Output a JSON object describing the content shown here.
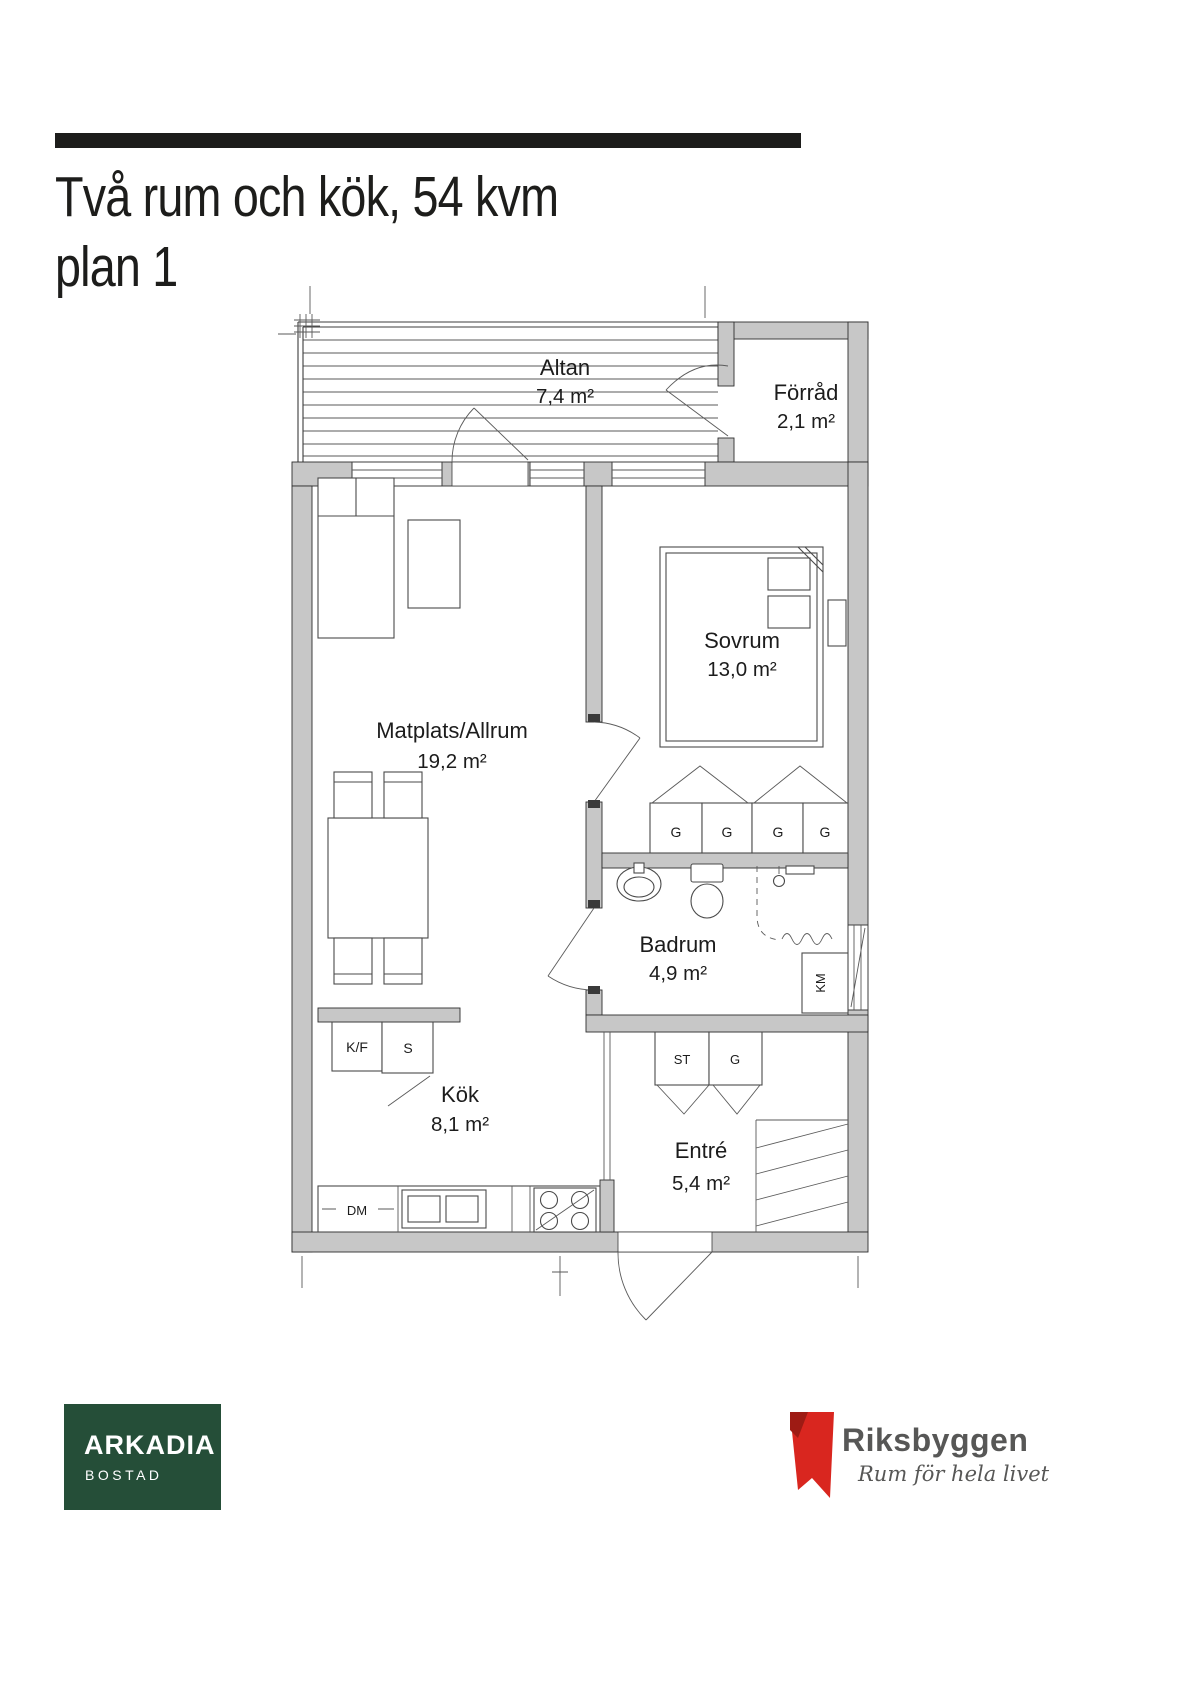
{
  "header": {
    "title_line1": "Två rum och kök, 54 kvm",
    "title_line2": "plan 1"
  },
  "floorplan": {
    "rooms": [
      {
        "name": "Altan",
        "area": "7,4 m²"
      },
      {
        "name": "Förråd",
        "area": "2,1 m²"
      },
      {
        "name": "Sovrum",
        "area": "13,0 m²"
      },
      {
        "name": "Matplats/Allrum",
        "area": "19,2 m²"
      },
      {
        "name": "Badrum",
        "area": "4,9 m²"
      },
      {
        "name": "Kök",
        "area": "8,1 m²"
      },
      {
        "name": "Entré",
        "area": "5,4 m²"
      }
    ],
    "fixtures": {
      "wardrobe": "G",
      "washing_machine": "KM",
      "hall_cabinet": "ST",
      "hall_wardrobe": "G",
      "fridge_freezer": "K/F",
      "pantry": "S",
      "dishwasher": "DM"
    },
    "wall_color": "#c7c7c7"
  },
  "footer": {
    "arkadia": {
      "name": "ARKADIA",
      "subtitle": "BOSTAD",
      "bg_color": "#254e38"
    },
    "riksbyggen": {
      "name": "Riksbyggen",
      "tagline": "Rum för hela livet",
      "brand_red": "#d9261f",
      "text_color": "#575756"
    }
  }
}
